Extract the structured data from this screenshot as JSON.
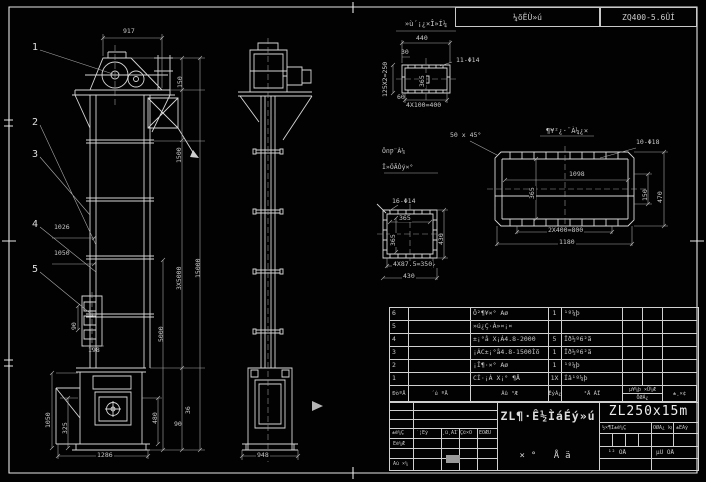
{
  "header": {
    "left_cell": "¼õËÙ»ú",
    "right_cell": "ZQ400-5.6ÛÍ"
  },
  "front": {
    "balloons": [
      "1",
      "2",
      "3",
      "4",
      "5"
    ],
    "dims": {
      "w917": "917",
      "d150": "150",
      "d1500": "1500",
      "d3x5000": "3X5000",
      "d15000": "15000",
      "d5000": "5000",
      "d1026": "1026",
      "d1050": "1050",
      "d90v": "90",
      "d198": "198",
      "d480": "480",
      "d36": "36",
      "d90b": "90",
      "d1050b": "1050",
      "d325": "325",
      "d1286": "1286"
    }
  },
  "side": {
    "d948": "948"
  },
  "detail_top": {
    "title": "»ù´¡¿×Î»Í¼",
    "holes": "11-Φ14",
    "d440": "440",
    "d30": "30",
    "dleft": "125X2=250",
    "dinner": "365",
    "d60": "60",
    "dbottom": "4X100=400"
  },
  "detail_right": {
    "title": "¶¥²¿·¨À¼¿×",
    "chamfer": "50 x 45°",
    "holes": "10-Φ18",
    "d1098": "1098",
    "d365": "365",
    "d150": "150",
    "d470": "470",
    "d800": "2X400=800",
    "d1180": "1180"
  },
  "detail_left": {
    "title1": "ÖпǷ¨À¼",
    "title2": "Î»ÖÃÒý×°",
    "holes": "16-Φ14",
    "d365h": "365",
    "d365v": "365",
    "d430r": "430",
    "db1": "4X87.5=350",
    "db2": "430"
  },
  "bom": {
    "rows": [
      {
        "no": "6",
        "code": "",
        "name": "Ô²¶¥×° Aø",
        "qty": "1",
        "mat": "¹º¼þ"
      },
      {
        "no": "5",
        "code": "",
        "name": "»ú¿Ç·À»¤¡¤",
        "qty": "",
        "mat": ""
      },
      {
        "no": "4",
        "code": "",
        "name": "±¡°å X¡Á4.8-2000",
        "qty": "5",
        "mat": "Ïð½º6²ã"
      },
      {
        "no": "3",
        "code": "",
        "name": "¡ÁC±¡°å4.8-1500Ìõ",
        "qty": "1",
        "mat": "Ïð½º6²ã"
      },
      {
        "no": "2",
        "code": "",
        "name": "¡Î¶·×° Aø",
        "qty": "1",
        "mat": "¹º¼þ"
      },
      {
        "no": "1",
        "code": "",
        "name": "CÍ·¡Á X¡° ¶Å",
        "qty": "1X",
        "mat": "Íâ¹º¼þ"
      }
    ],
    "header": {
      "no": "ÐòºÅ",
      "code": "´ú ºÅ",
      "name": "Ãû ³Æ",
      "qty": "ÊýÁ¿",
      "mat": "²Ä ÁÏ",
      "w_top": "µ¥¼þ ×Ü¼Æ",
      "w_bottom": "ÖØÁ¿",
      "note": "±¸×¢"
    }
  },
  "titleblock": {
    "sign_row": [
      "±ê¼Ç",
      "´¦Êý",
      "¸ü¸ÄÎļþºÅ",
      "Ç©×Ö",
      "ÈÕÆÚ"
    ],
    "design": "Éè¼Æ",
    "approve": "Åú ×¼",
    "main_title": "ZL¶·Ê½ÌáÉý»ú",
    "assembly": "×° Åä",
    "model": "ZL250x15m",
    "stage": [
      "½×¶Î±ê¼Ç",
      "ÖØÁ¿ kg",
      "±ÈÀý"
    ],
    "sheet": [
      "¹² ÕÅ",
      "µÚ ÕÅ"
    ]
  }
}
